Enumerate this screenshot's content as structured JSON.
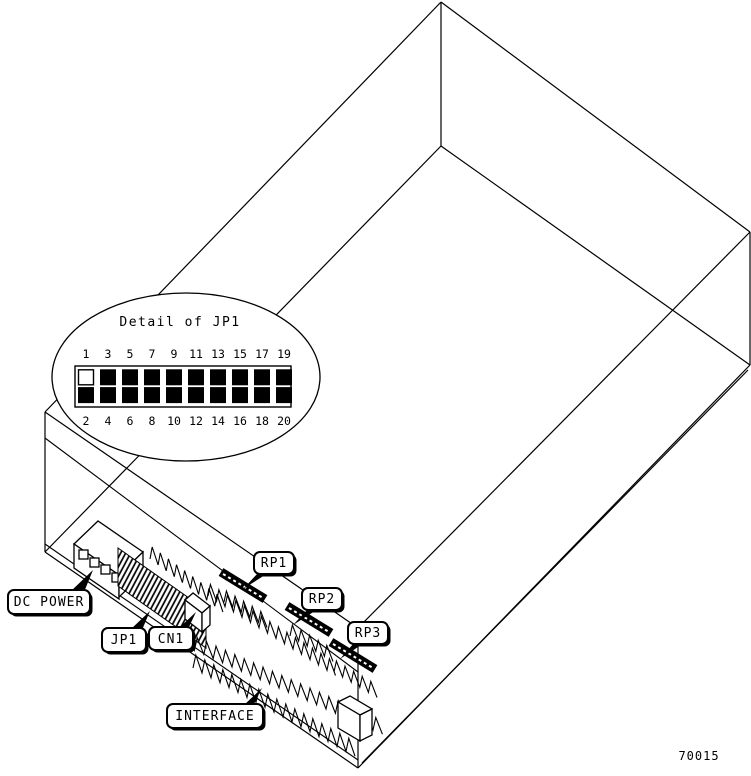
{
  "figure": {
    "part_number": "70015",
    "detail": {
      "title": "Detail of JP1",
      "pins_top": [
        "1",
        "3",
        "5",
        "7",
        "9",
        "11",
        "13",
        "15",
        "17",
        "19"
      ],
      "pins_bottom": [
        "2",
        "4",
        "6",
        "8",
        "10",
        "12",
        "14",
        "16",
        "18",
        "20"
      ],
      "pin_open_fill": "#ffffff",
      "pin_filled_fill": "#000000"
    },
    "callouts": {
      "dc_power": "DC POWER",
      "jp1": "JP1",
      "cn1": "CN1",
      "rp1": "RP1",
      "rp2": "RP2",
      "rp3": "RP3",
      "interface": "INTERFACE"
    },
    "colors": {
      "line": "#000000",
      "background": "#ffffff"
    }
  }
}
